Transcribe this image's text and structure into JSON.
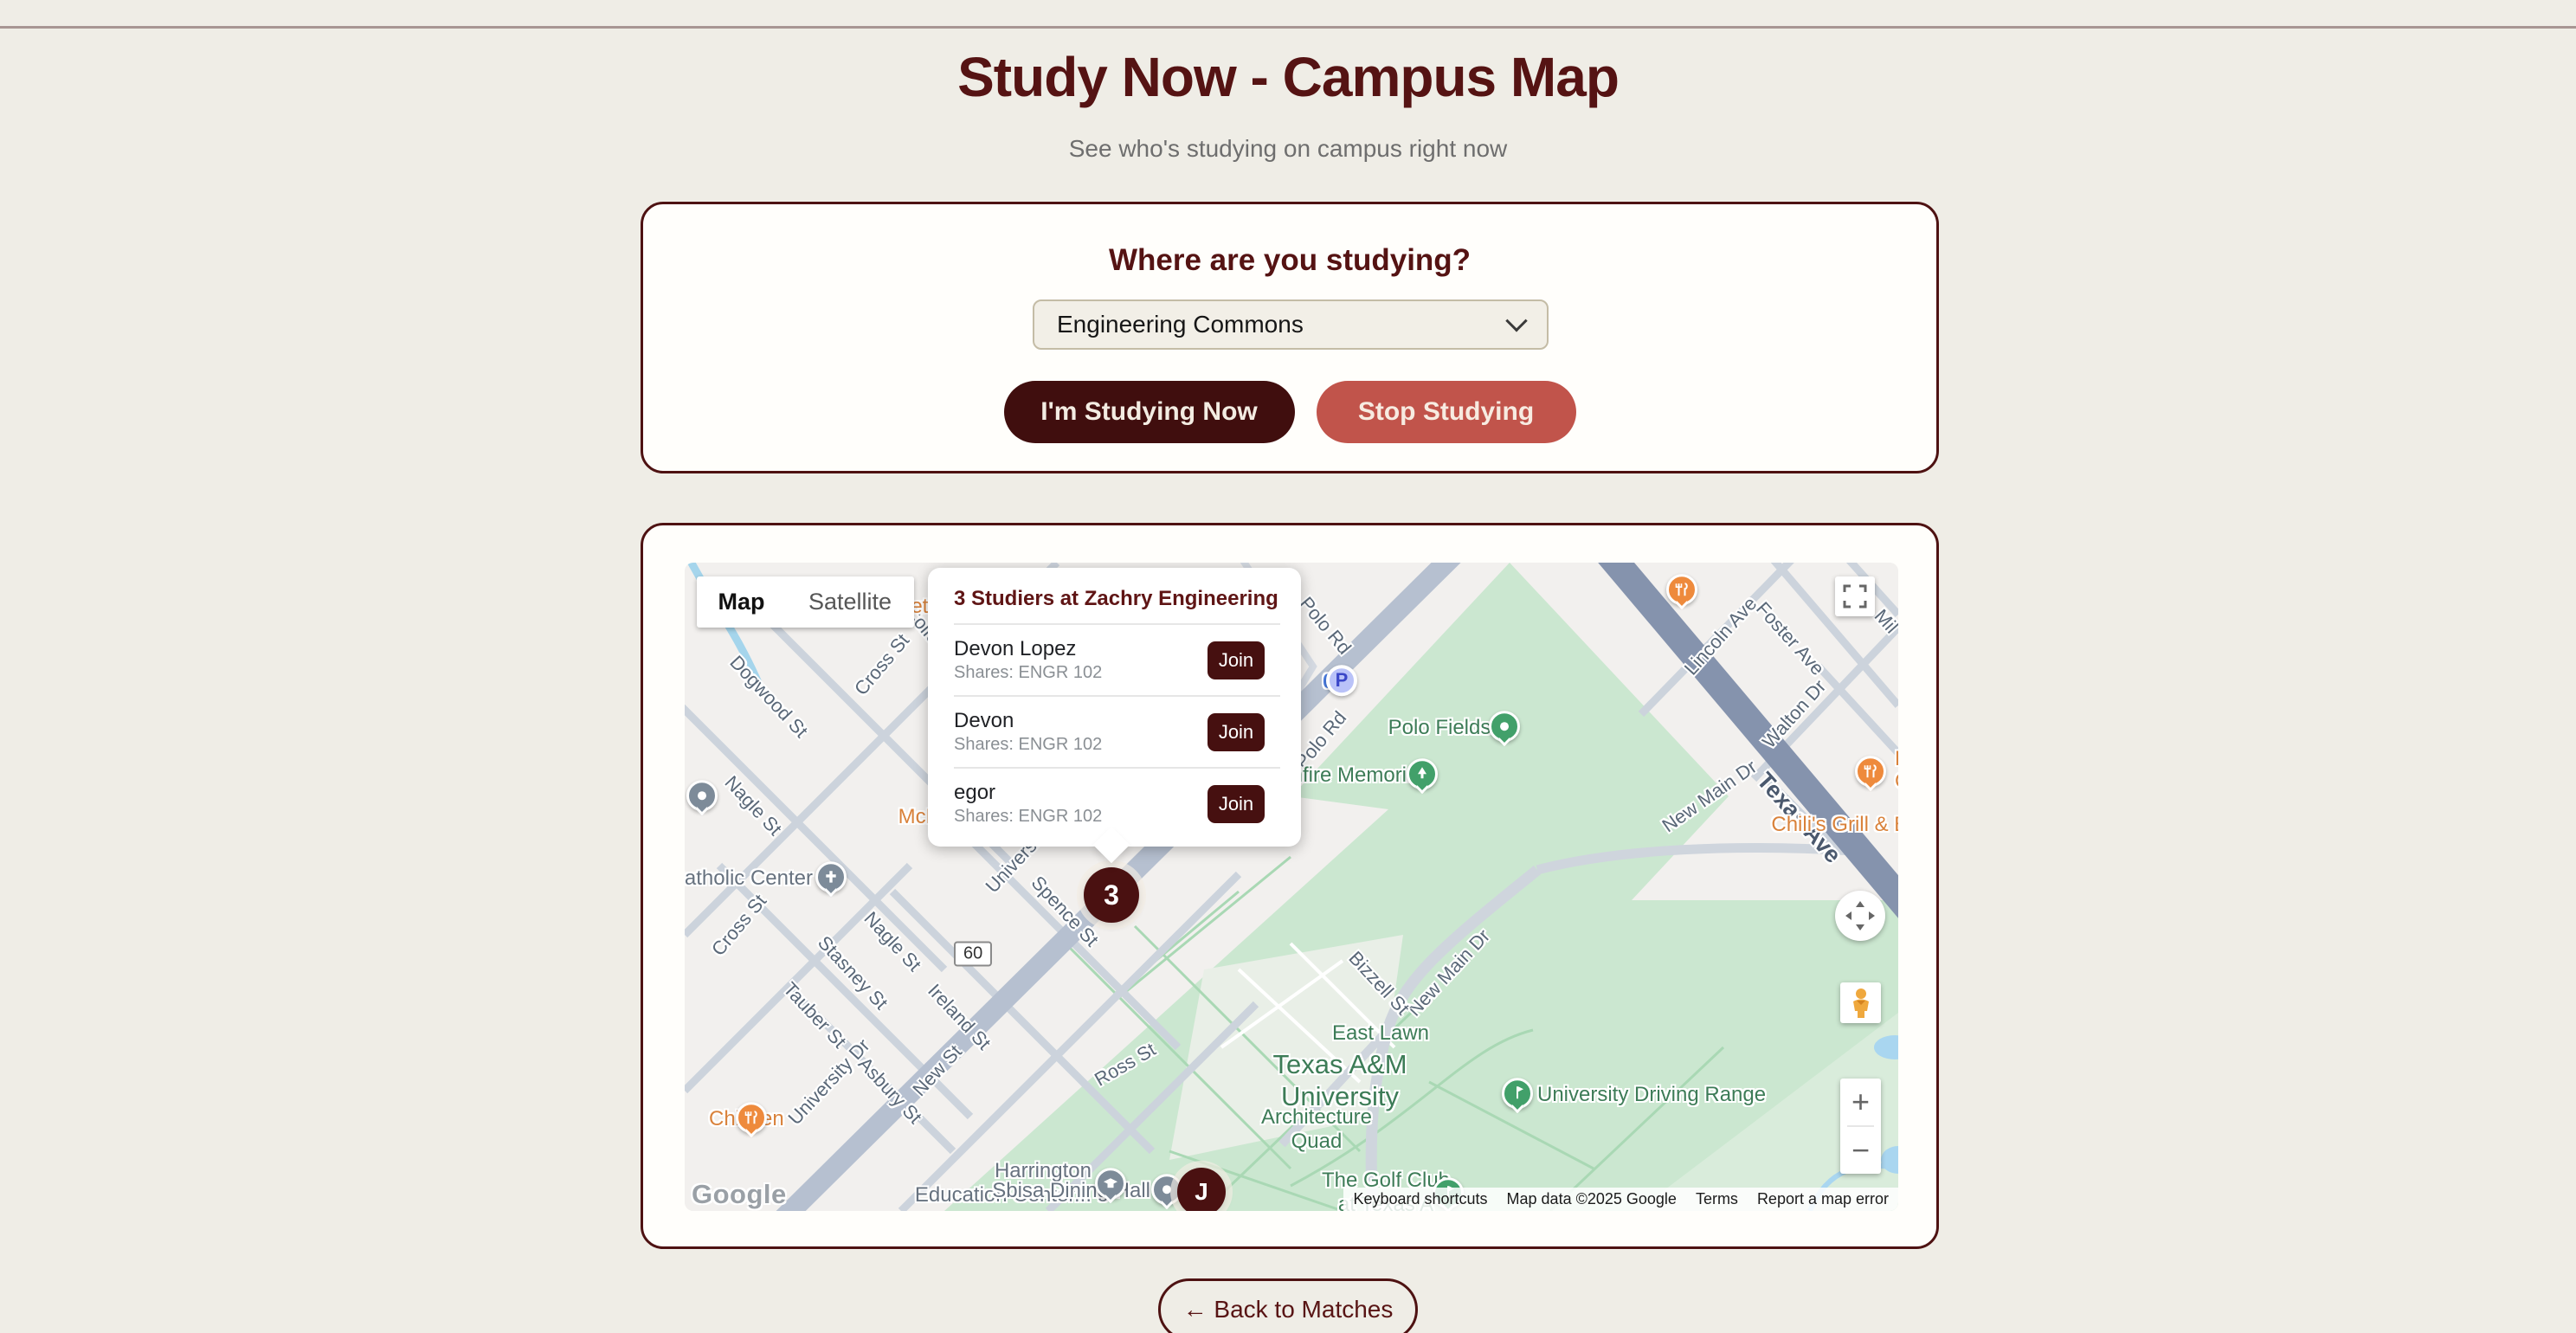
{
  "colors": {
    "maroon_dark": "#400e0e",
    "maroon_border": "#4e1212",
    "red_stop": "#c1544b",
    "cream_bg": "#efede6",
    "join_btn": "#461010",
    "park_green": "#cbe7d0",
    "poi_orange": "#d9823b"
  },
  "page": {
    "title": "Study Now - Campus Map",
    "subtitle": "See who's studying on campus right now"
  },
  "form": {
    "heading": "Where are you studying?",
    "location_select": {
      "value": "Engineering Commons"
    },
    "start_button": "I'm Studying Now",
    "stop_button": "Stop Studying"
  },
  "map": {
    "controls": {
      "map_label": "Map",
      "satellite_label": "Satellite",
      "zoom_in": "+",
      "zoom_out": "−"
    },
    "markers": {
      "cluster": "3",
      "user": "J"
    },
    "popup": {
      "title": "3 Studiers at Zachry Engineering",
      "studiers": [
        {
          "name": "Devon Lopez",
          "shares": "Shares: ENGR 102",
          "join": "Join"
        },
        {
          "name": "Devon",
          "shares": "Shares: ENGR 102",
          "join": "Join"
        },
        {
          "name": "egor",
          "shares": "Shares: ENGR 102",
          "join": "Join"
        }
      ]
    },
    "google_logo": "Google",
    "attribution": {
      "keyboard": "Keyboard shortcuts",
      "map_data": "Map data ©2025 Google",
      "terms": "Terms",
      "report": "Report a map error"
    },
    "street_labels": {
      "dogwood": "Dogwood St",
      "cross_upper": "Cross St",
      "college_main": "College Main",
      "cross_lower": "Cross St",
      "nagle_upper": "Nagle St",
      "nagle_lower": "Nagle St",
      "stasney": "Stasney St",
      "tauber": "Tauber St",
      "university_dr": "University Dr",
      "university_dr_2": "University Dr",
      "asbury": "Asbury St",
      "ireland": "Ireland St",
      "new_st": "New St",
      "ross": "Ross St",
      "spence": "Spence St",
      "polo_rd_1": "Polo Rd",
      "polo_rd_2": "Polo Rd",
      "lincoln": "Lincoln Ave",
      "foster": "Foster Ave",
      "walton": "Walton Dr",
      "mil": "Mil",
      "texas_ave": "Texas Ave",
      "new_main_1": "New Main Dr",
      "new_main_2": "New Main Dr",
      "bizzell": "Bizzell St",
      "route_60": "60"
    },
    "place_labels": {
      "polo_fields": "Polo Fields",
      "bonfire_memorial": "Bonfire Memorial",
      "east_lawn": "East Lawn",
      "tamu": "Texas A&M\nUniversity",
      "architecture_quad": "Architecture\nQuad",
      "driving_range": "University Driving Range",
      "golf_club": "The Golf Club\nat Texas A",
      "harrington": "Harrington\nEducation Center...",
      "sbisa": "Sbisa Dining Hall",
      "catholic_center": "Catholic Center",
      "zero": "0",
      "parking": "P"
    },
    "poi_labels": {
      "metro": "Metro",
      "mcdonalds": "McDonald's",
      "chicken": "Chicken",
      "chilis": "Chili's Grill & Bar",
      "fc": "Fu\nCa"
    }
  },
  "back_button": {
    "label": "← Back to Matches"
  }
}
